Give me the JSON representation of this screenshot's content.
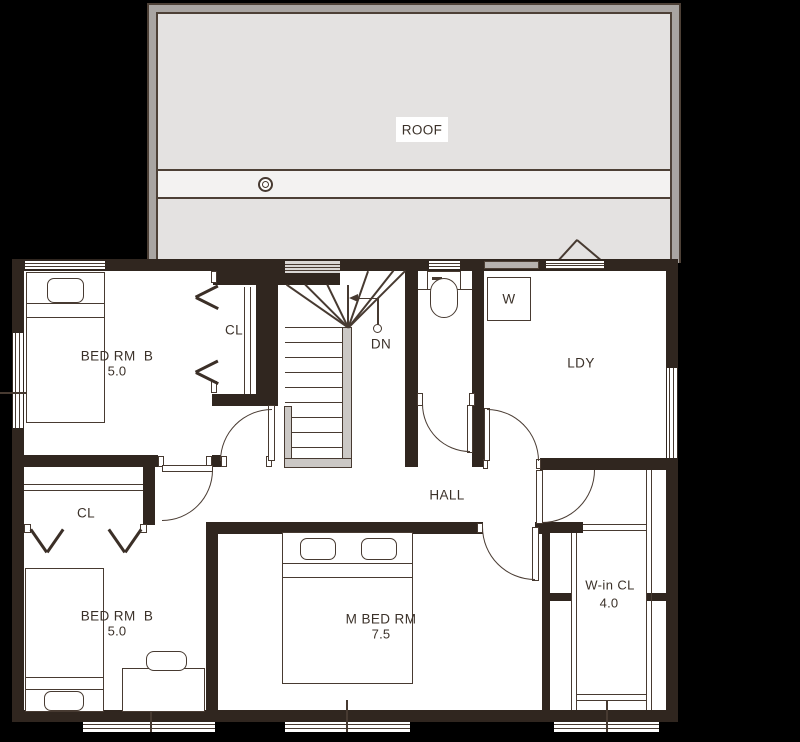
{
  "colors": {
    "background": "#000000",
    "wall": "#30261f",
    "line": "#473a31",
    "floor": "#ffffff",
    "roof_border": "#a9a5a2",
    "roof_fill": "#e4e2e1",
    "roof_band": "#f3f2f1"
  },
  "roof": {
    "label": "ROOF"
  },
  "rooms": {
    "bedroom_top": {
      "name": "BED RM  B",
      "area": "5.0"
    },
    "closet_top": {
      "label": "CL"
    },
    "stairs": {
      "down_label": "DN"
    },
    "laundry": {
      "name": "LDY"
    },
    "washer": {
      "label": "W"
    },
    "hall": {
      "name": "HALL"
    },
    "closet_bottom": {
      "label": "CL"
    },
    "bedroom_bottom": {
      "name": "BED RM  B",
      "area": "5.0"
    },
    "master_bedroom": {
      "name": "M BED RM",
      "area": "7.5"
    },
    "walk_in_closet": {
      "name": "W-in CL",
      "area": "4.0"
    }
  }
}
